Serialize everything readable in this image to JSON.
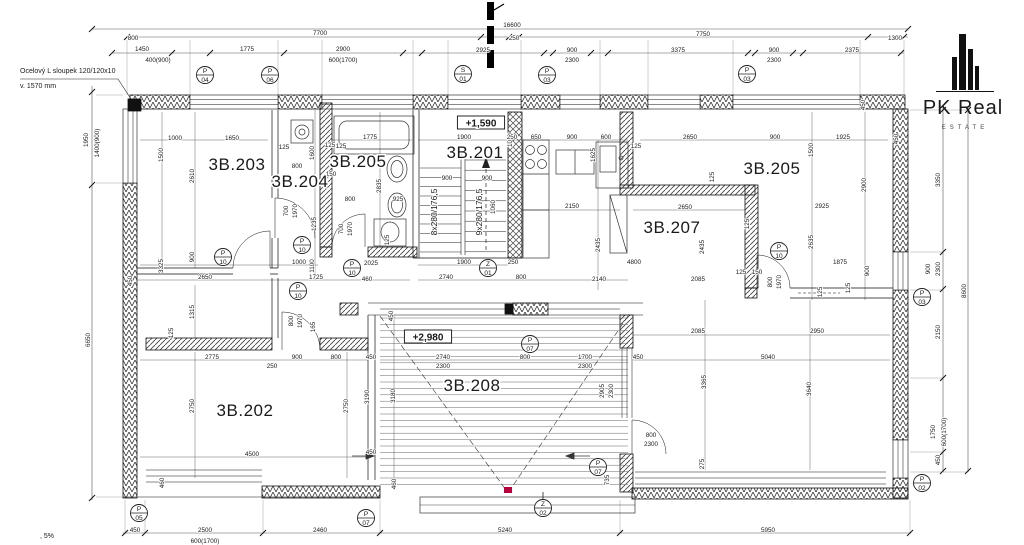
{
  "logo": {
    "name": "PK Real",
    "sub": "ESTATE"
  },
  "notes": {
    "steel_column_1": "Ocelový L sloupek 120/120x10",
    "steel_column_2": "v. 1570 mm",
    "slope": ", 5%"
  },
  "levels": [
    {
      "text": "+1,590",
      "x": 481,
      "y": 124
    },
    {
      "text": "+2,980",
      "x": 428,
      "y": 338
    }
  ],
  "rooms": [
    {
      "label": "3B.203",
      "x": 237,
      "y": 170,
      "s": 17
    },
    {
      "label": "3B.204",
      "x": 300,
      "y": 187,
      "s": 14
    },
    {
      "label": "3B.205",
      "x": 358,
      "y": 167,
      "s": 13
    },
    {
      "label": "3B.201",
      "x": 475,
      "y": 158,
      "s": 17
    },
    {
      "label": "3B.205",
      "x": 772,
      "y": 174,
      "s": 17
    },
    {
      "label": "3B.207",
      "x": 672,
      "y": 233,
      "s": 17
    },
    {
      "label": "3B.202",
      "x": 245,
      "y": 416,
      "s": 17
    },
    {
      "label": "3B.208",
      "x": 472,
      "y": 391,
      "s": 17
    }
  ],
  "stairs": {
    "left_flight": "8x280/176,5",
    "right_flight": "9x280/176,5"
  },
  "markers": [
    {
      "l": "P",
      "n": "04",
      "x": 205,
      "y": 75
    },
    {
      "l": "P",
      "n": "06",
      "x": 270,
      "y": 75
    },
    {
      "l": "S",
      "n": "01",
      "x": 463,
      "y": 74
    },
    {
      "l": "P",
      "n": "03",
      "x": 547,
      "y": 75
    },
    {
      "l": "P",
      "n": "03",
      "x": 747,
      "y": 74
    },
    {
      "l": "P",
      "n": "03",
      "x": 922,
      "y": 297
    },
    {
      "l": "P",
      "n": "02",
      "x": 922,
      "y": 483
    },
    {
      "l": "P",
      "n": "05",
      "x": 139,
      "y": 513
    },
    {
      "l": "P",
      "n": "07",
      "x": 366,
      "y": 518
    },
    {
      "l": "Z",
      "n": "02",
      "x": 543,
      "y": 508
    },
    {
      "l": "Z",
      "n": "01",
      "x": 488,
      "y": 268
    },
    {
      "l": "P",
      "n": "10",
      "x": 223,
      "y": 257
    },
    {
      "l": "P",
      "n": "10",
      "x": 302,
      "y": 245
    },
    {
      "l": "P",
      "n": "10",
      "x": 352,
      "y": 268
    },
    {
      "l": "P",
      "n": "10",
      "x": 298,
      "y": 291
    },
    {
      "l": "P",
      "n": "10",
      "x": 779,
      "y": 251
    },
    {
      "l": "P",
      "n": "07",
      "x": 530,
      "y": 344
    },
    {
      "l": "P",
      "n": "07",
      "x": 598,
      "y": 467
    }
  ],
  "dims": [
    {
      "t": "16600",
      "x": 512,
      "y": 25
    },
    {
      "t": "800",
      "x": 133,
      "y": 38
    },
    {
      "t": "7700",
      "x": 320,
      "y": 33
    },
    {
      "t": "250",
      "x": 514,
      "y": 38
    },
    {
      "t": "7750",
      "x": 703,
      "y": 34
    },
    {
      "t": "1300",
      "x": 895,
      "y": 38
    },
    {
      "t": "1450",
      "x": 142,
      "y": 49
    },
    {
      "t": "1775",
      "x": 247,
      "y": 49
    },
    {
      "t": "2900",
      "x": 343,
      "y": 49
    },
    {
      "t": "2925",
      "x": 483,
      "y": 50
    },
    {
      "t": "900",
      "x": 572,
      "y": 50
    },
    {
      "t": "3375",
      "x": 678,
      "y": 50
    },
    {
      "t": "900",
      "x": 774,
      "y": 50
    },
    {
      "t": "2375",
      "x": 852,
      "y": 50
    },
    {
      "t": "400(900)",
      "x": 158,
      "y": 60
    },
    {
      "t": "600(1700)",
      "x": 343,
      "y": 60
    },
    {
      "t": "2300",
      "x": 572,
      "y": 60
    },
    {
      "t": "2300",
      "x": 774,
      "y": 60
    },
    {
      "t": "1950",
      "x": 86,
      "y": 140,
      "v": 1
    },
    {
      "t": "1400(900)",
      "x": 97,
      "y": 143,
      "v": 1
    },
    {
      "t": "6650",
      "x": 88,
      "y": 340,
      "v": 1
    },
    {
      "t": "450",
      "x": 130,
      "y": 281,
      "v": 1
    },
    {
      "t": "450",
      "x": 135,
      "y": 530
    },
    {
      "t": "2500",
      "x": 205,
      "y": 530
    },
    {
      "t": "600(1700)",
      "x": 205,
      "y": 541
    },
    {
      "t": "2460",
      "x": 320,
      "y": 530
    },
    {
      "t": "5240",
      "x": 505,
      "y": 530
    },
    {
      "t": "5950",
      "x": 768,
      "y": 530
    },
    {
      "t": "3350",
      "x": 938,
      "y": 180,
      "v": 1
    },
    {
      "t": "900",
      "x": 928,
      "y": 269,
      "v": 1
    },
    {
      "t": "2300",
      "x": 938,
      "y": 269,
      "v": 1
    },
    {
      "t": "2150",
      "x": 938,
      "y": 332,
      "v": 1
    },
    {
      "t": "8600",
      "x": 964,
      "y": 291,
      "v": 1
    },
    {
      "t": "1750",
      "x": 933,
      "y": 432,
      "v": 1
    },
    {
      "t": "600(1700)",
      "x": 944,
      "y": 432,
      "v": 1
    },
    {
      "t": "450",
      "x": 938,
      "y": 460,
      "v": 1
    },
    {
      "t": "1000",
      "x": 175,
      "y": 138
    },
    {
      "t": "1650",
      "x": 232,
      "y": 138
    },
    {
      "t": "1500",
      "x": 161,
      "y": 155,
      "v": 1
    },
    {
      "t": "2610",
      "x": 192,
      "y": 176,
      "v": 1
    },
    {
      "t": "125",
      "x": 284,
      "y": 147
    },
    {
      "t": "800",
      "x": 297,
      "y": 166
    },
    {
      "t": "150",
      "x": 331,
      "y": 174
    },
    {
      "t": "900",
      "x": 192,
      "y": 257,
      "v": 1
    },
    {
      "t": "3325",
      "x": 161,
      "y": 266,
      "v": 1
    },
    {
      "t": "2650",
      "x": 205,
      "y": 277
    },
    {
      "t": "1725",
      "x": 316,
      "y": 277
    },
    {
      "t": "1600",
      "x": 312,
      "y": 153,
      "v": 1
    },
    {
      "t": "125",
      "x": 330,
      "y": 145
    },
    {
      "t": "700",
      "x": 286,
      "y": 211,
      "v": 1
    },
    {
      "t": "1970",
      "x": 295,
      "y": 211,
      "v": 1
    },
    {
      "t": "1235",
      "x": 314,
      "y": 224,
      "v": 1
    },
    {
      "t": "1000",
      "x": 299,
      "y": 262
    },
    {
      "t": "1100",
      "x": 312,
      "y": 266,
      "v": 1
    },
    {
      "t": "1775",
      "x": 370,
      "y": 137
    },
    {
      "t": "125",
      "x": 341,
      "y": 146
    },
    {
      "t": "2835",
      "x": 379,
      "y": 186,
      "v": 1
    },
    {
      "t": "800",
      "x": 350,
      "y": 199
    },
    {
      "t": "925",
      "x": 398,
      "y": 199
    },
    {
      "t": "700",
      "x": 341,
      "y": 229,
      "v": 1
    },
    {
      "t": "1970",
      "x": 350,
      "y": 229,
      "v": 1
    },
    {
      "t": "125",
      "x": 387,
      "y": 240,
      "v": 1
    },
    {
      "t": "2025",
      "x": 371,
      "y": 263
    },
    {
      "t": "460",
      "x": 367,
      "y": 279
    },
    {
      "t": "1900",
      "x": 464,
      "y": 137
    },
    {
      "t": "1000",
      "x": 510,
      "y": 140,
      "v": 1
    },
    {
      "t": "900",
      "x": 447,
      "y": 178
    },
    {
      "t": "900",
      "x": 487,
      "y": 178
    },
    {
      "t": "1060",
      "x": 493,
      "y": 207,
      "v": 1
    },
    {
      "t": "1900",
      "x": 464,
      "y": 262
    },
    {
      "t": "250",
      "x": 513,
      "y": 262
    },
    {
      "t": "2740",
      "x": 446,
      "y": 277
    },
    {
      "t": "800",
      "x": 521,
      "y": 277
    },
    {
      "t": "250",
      "x": 512,
      "y": 137
    },
    {
      "t": "650",
      "x": 536,
      "y": 137
    },
    {
      "t": "900",
      "x": 572,
      "y": 137
    },
    {
      "t": "600",
      "x": 606,
      "y": 137
    },
    {
      "t": "1625",
      "x": 593,
      "y": 155,
      "v": 1
    },
    {
      "t": "2150",
      "x": 572,
      "y": 206
    },
    {
      "t": "2435",
      "x": 598,
      "y": 245,
      "v": 1
    },
    {
      "t": "2650",
      "x": 690,
      "y": 137
    },
    {
      "t": "900",
      "x": 775,
      "y": 137
    },
    {
      "t": "125",
      "x": 636,
      "y": 146
    },
    {
      "t": "125",
      "x": 712,
      "y": 177,
      "v": 1
    },
    {
      "t": "2650",
      "x": 685,
      "y": 207
    },
    {
      "t": "2435",
      "x": 702,
      "y": 247,
      "v": 1
    },
    {
      "t": "125",
      "x": 747,
      "y": 224,
      "v": 1
    },
    {
      "t": "4800",
      "x": 634,
      "y": 262
    },
    {
      "t": "2140",
      "x": 599,
      "y": 279
    },
    {
      "t": "2085",
      "x": 698,
      "y": 279
    },
    {
      "t": "125",
      "x": 741,
      "y": 272
    },
    {
      "t": "150",
      "x": 757,
      "y": 272
    },
    {
      "t": "800",
      "x": 770,
      "y": 282,
      "v": 1
    },
    {
      "t": "1970",
      "x": 779,
      "y": 282,
      "v": 1
    },
    {
      "t": "125",
      "x": 820,
      "y": 292,
      "v": 1
    },
    {
      "t": "1925",
      "x": 843,
      "y": 137
    },
    {
      "t": "450",
      "x": 863,
      "y": 105,
      "v": 1
    },
    {
      "t": "450",
      "x": 896,
      "y": 139,
      "v": 1
    },
    {
      "t": "1500",
      "x": 811,
      "y": 150,
      "v": 1
    },
    {
      "t": "2900",
      "x": 864,
      "y": 185,
      "v": 1
    },
    {
      "t": "2925",
      "x": 822,
      "y": 206
    },
    {
      "t": "2635",
      "x": 811,
      "y": 242,
      "v": 1
    },
    {
      "t": "1875",
      "x": 840,
      "y": 262
    },
    {
      "t": "900",
      "x": 867,
      "y": 271,
      "v": 1
    },
    {
      "t": "125",
      "x": 848,
      "y": 288,
      "v": 1
    },
    {
      "t": "2085",
      "x": 698,
      "y": 331
    },
    {
      "t": "2950",
      "x": 817,
      "y": 331
    },
    {
      "t": "450",
      "x": 638,
      "y": 357
    },
    {
      "t": "5040",
      "x": 768,
      "y": 357
    },
    {
      "t": "3365",
      "x": 704,
      "y": 382,
      "v": 1
    },
    {
      "t": "3640",
      "x": 809,
      "y": 389,
      "v": 1
    },
    {
      "t": "2905",
      "x": 602,
      "y": 391,
      "v": 1
    },
    {
      "t": "2300",
      "x": 611,
      "y": 391,
      "v": 1
    },
    {
      "t": "800",
      "x": 651,
      "y": 435
    },
    {
      "t": "2300",
      "x": 651,
      "y": 444
    },
    {
      "t": "275",
      "x": 702,
      "y": 464,
      "v": 1
    },
    {
      "t": "735",
      "x": 607,
      "y": 480,
      "v": 1
    },
    {
      "t": "450",
      "x": 391,
      "y": 316,
      "v": 1
    },
    {
      "t": "450",
      "x": 371,
      "y": 357
    },
    {
      "t": "2740",
      "x": 443,
      "y": 357
    },
    {
      "t": "2300",
      "x": 443,
      "y": 366
    },
    {
      "t": "800",
      "x": 525,
      "y": 357
    },
    {
      "t": "1700",
      "x": 585,
      "y": 357
    },
    {
      "t": "2300",
      "x": 585,
      "y": 366
    },
    {
      "t": "3180",
      "x": 393,
      "y": 396,
      "v": 1
    },
    {
      "t": "450",
      "x": 371,
      "y": 452
    },
    {
      "t": "460",
      "x": 394,
      "y": 484,
      "v": 1
    },
    {
      "t": "1315",
      "x": 192,
      "y": 312,
      "v": 1
    },
    {
      "t": "125",
      "x": 171,
      "y": 333,
      "v": 1
    },
    {
      "t": "2775",
      "x": 212,
      "y": 357
    },
    {
      "t": "250",
      "x": 272,
      "y": 366
    },
    {
      "t": "900",
      "x": 297,
      "y": 357
    },
    {
      "t": "800",
      "x": 336,
      "y": 357
    },
    {
      "t": "2750",
      "x": 192,
      "y": 406,
      "v": 1
    },
    {
      "t": "2750",
      "x": 346,
      "y": 406,
      "v": 1
    },
    {
      "t": "3190",
      "x": 367,
      "y": 397,
      "v": 1
    },
    {
      "t": "4500",
      "x": 252,
      "y": 454
    },
    {
      "t": "460",
      "x": 162,
      "y": 483,
      "v": 1
    },
    {
      "t": "800",
      "x": 291,
      "y": 321,
      "v": 1
    },
    {
      "t": "1970",
      "x": 300,
      "y": 321,
      "v": 1
    },
    {
      "t": "165",
      "x": 313,
      "y": 327,
      "v": 1
    }
  ]
}
